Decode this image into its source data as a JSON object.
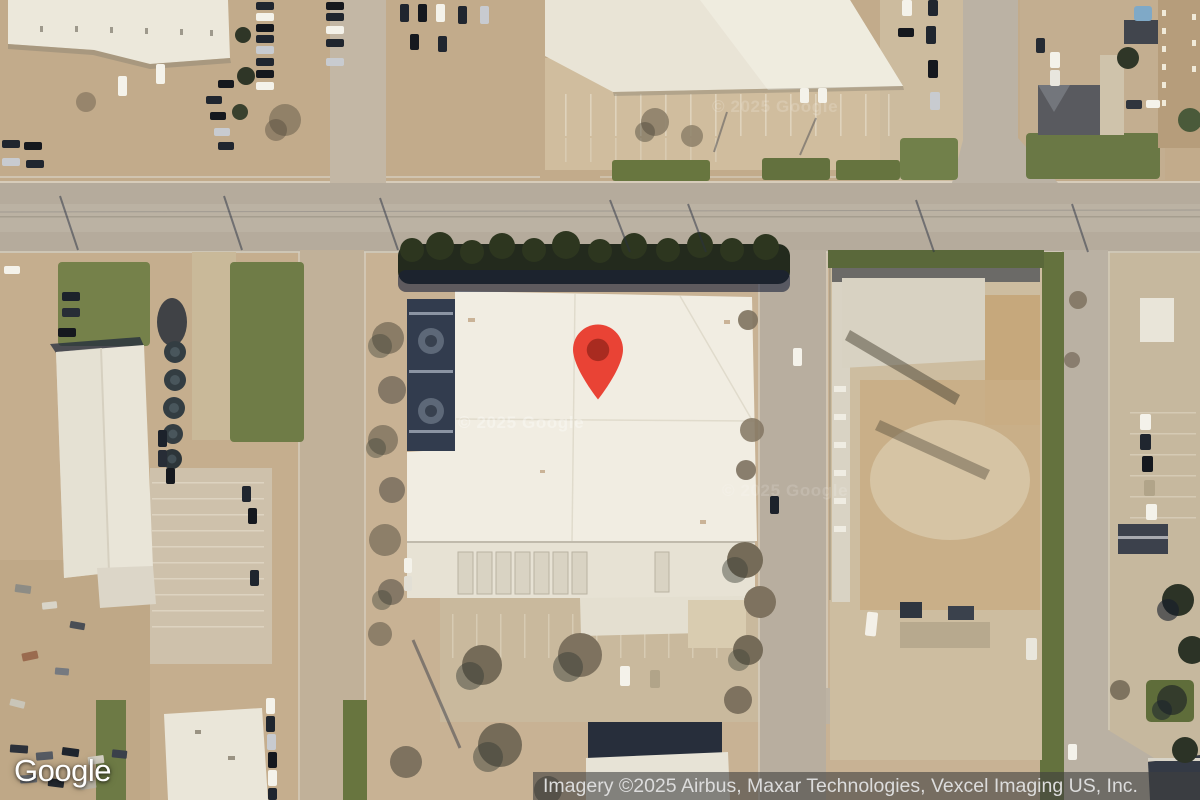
{
  "map": {
    "view_type": "satellite",
    "watermark_text": "© 2025 Google",
    "marker": {
      "icon": "map-pin",
      "body_color": "#E94335",
      "core_color": "#A92B20"
    }
  },
  "footer": {
    "logo_text": "Google",
    "attribution_text": "Imagery ©2025 Airbus, Maxar Technologies, Vexcel Imaging US, Inc."
  },
  "colors": {
    "attribution_bg": "rgba(64,64,64,0.6)",
    "attribution_fg": "#DCDCDC",
    "ground_tan": "#C8B294",
    "road_gray": "#B5AB9C",
    "roof_white": "#F1EDE2",
    "grass_green": "#6F7C47",
    "tree_dark": "#232A1D"
  }
}
